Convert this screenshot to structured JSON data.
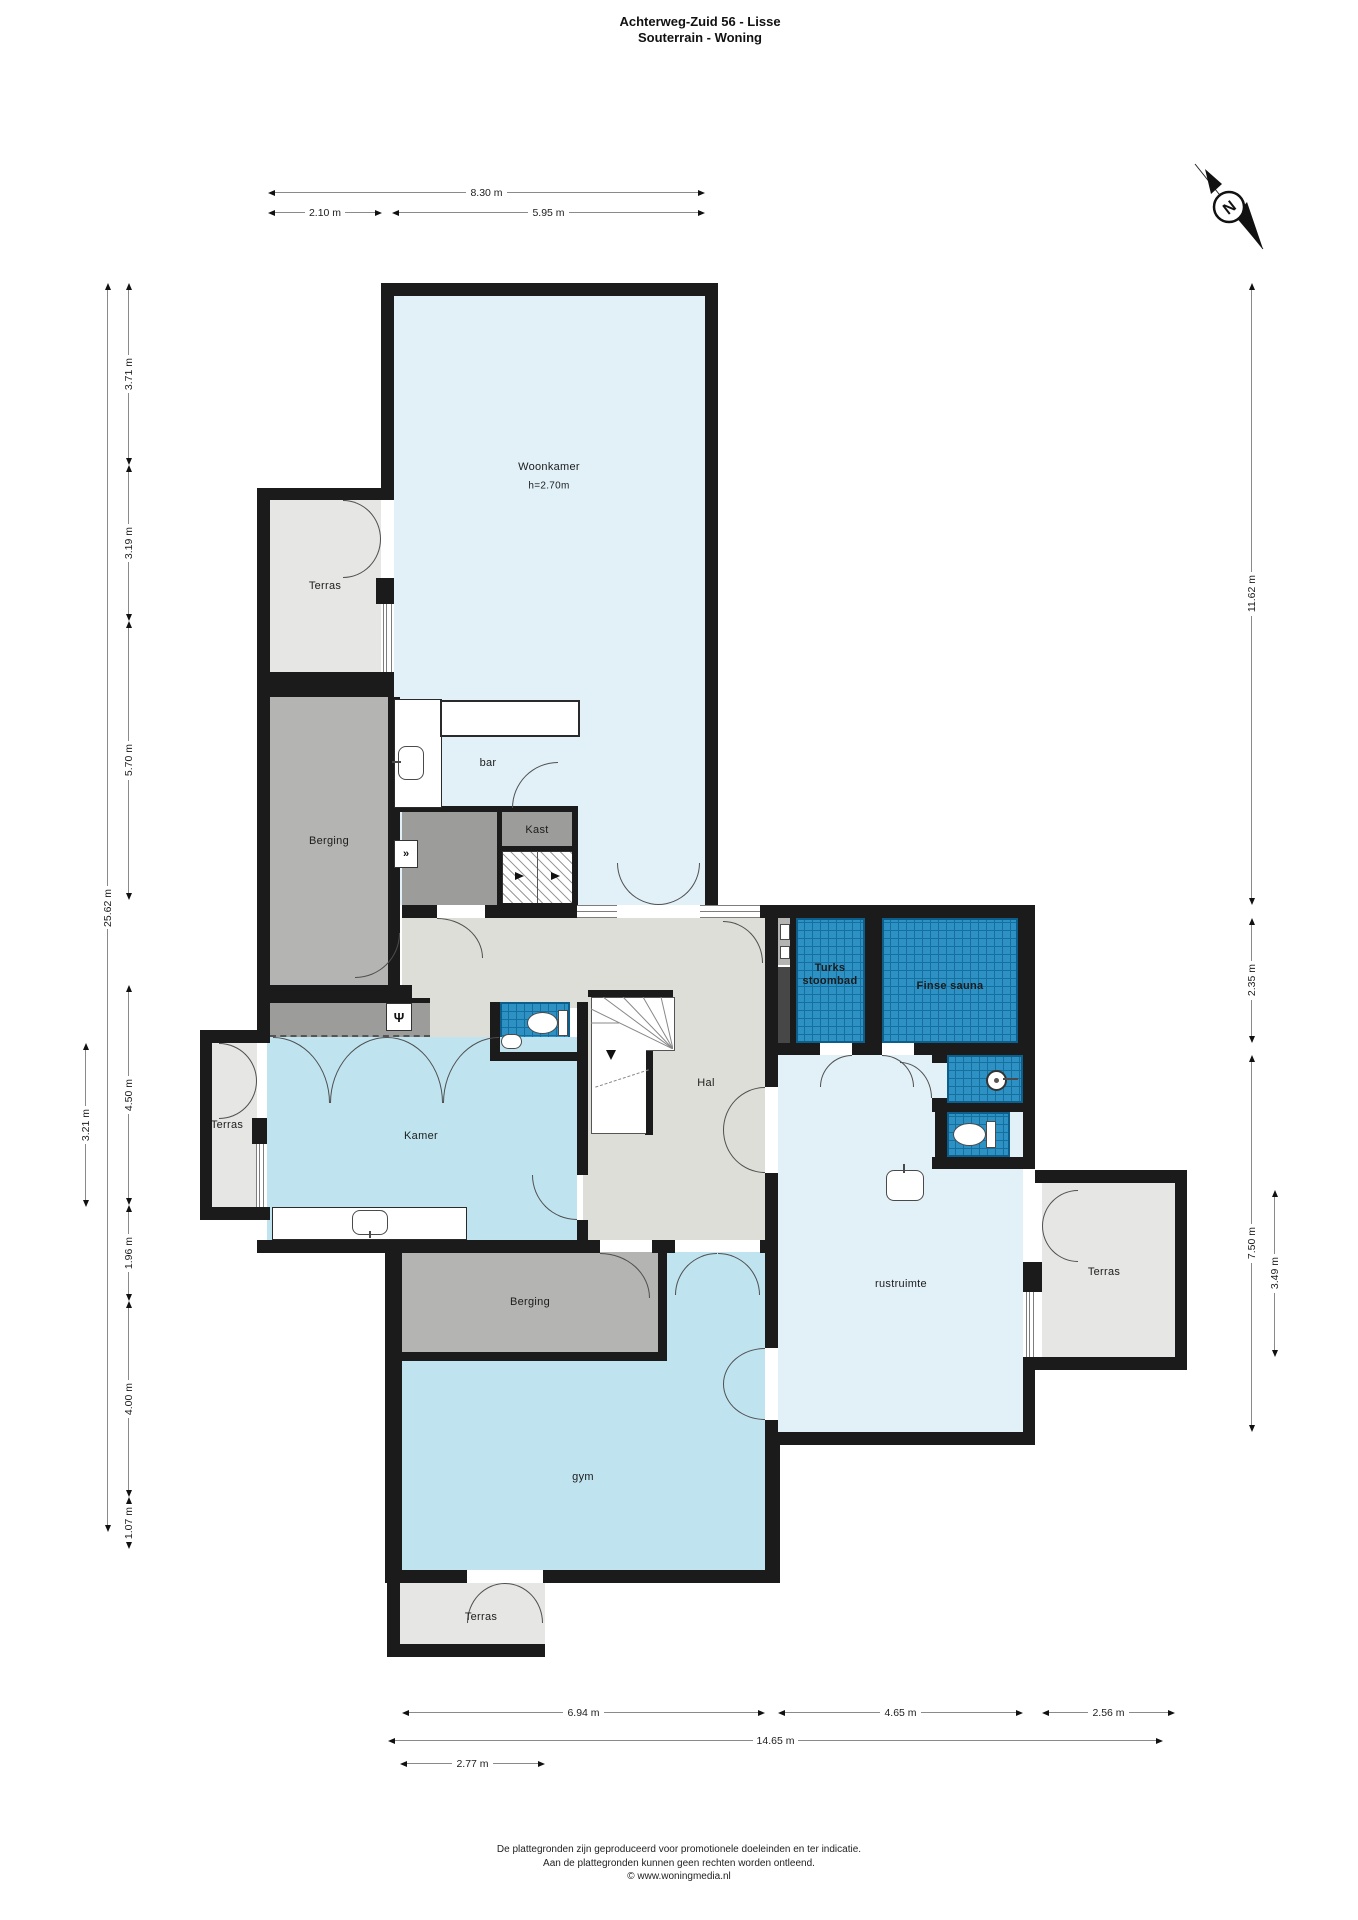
{
  "title": {
    "line1": "Achterweg-Zuid 56 - Lisse",
    "line2": "Souterrain - Woning"
  },
  "compass": {
    "label": "N"
  },
  "rooms": {
    "woonkamer": {
      "label": "Woonkamer",
      "height": "h=2.70m"
    },
    "terras_boven": {
      "label": "Terras"
    },
    "bar": {
      "label": "bar"
    },
    "berging_1": {
      "label": "Berging"
    },
    "kast": {
      "label": "Kast"
    },
    "hal": {
      "label": "Hal"
    },
    "kamer": {
      "label": "Kamer"
    },
    "terras_links": {
      "label": "Terras"
    },
    "turks_stoombad": {
      "label_line1": "Turks",
      "label_line2": "stoombad"
    },
    "finse_sauna": {
      "label": "Finse sauna"
    },
    "rustruimte": {
      "label": "rustruimte"
    },
    "terras_rechts": {
      "label": "Terras"
    },
    "berging_2": {
      "label": "Berging"
    },
    "gym": {
      "label": "gym"
    },
    "terras_onder": {
      "label": "Terras"
    }
  },
  "dims": {
    "top": [
      {
        "label": "8.30 m"
      },
      {
        "label": "2.10 m"
      },
      {
        "label": "5.95 m"
      }
    ],
    "left": [
      {
        "label": "25.62 m"
      },
      {
        "label": "3.71 m"
      },
      {
        "label": "3.19 m"
      },
      {
        "label": "5.70 m"
      },
      {
        "label": "4.50 m"
      },
      {
        "label": "1.96 m"
      },
      {
        "label": "4.00 m"
      },
      {
        "label": "1.07 m"
      },
      {
        "label": "3.21 m"
      }
    ],
    "right": [
      {
        "label": "11.62 m"
      },
      {
        "label": "2.35 m"
      },
      {
        "label": "7.50 m"
      },
      {
        "label": "3.49 m"
      }
    ],
    "bottom": [
      {
        "label": "6.94 m"
      },
      {
        "label": "4.65 m"
      },
      {
        "label": "2.56 m"
      },
      {
        "label": "14.65 m"
      },
      {
        "label": "2.77 m"
      }
    ]
  },
  "icons": {
    "wardrobe_glyph": "Ψ",
    "utility_glyph": "»"
  },
  "footer": {
    "line1": "De plattegronden zijn geproduceerd voor promotionele doeleinden en ter indicatie.",
    "line2": "Aan de plattegronden kunnen geen rechten worden ontleend.",
    "line3": "© www.woningmedia.nl"
  },
  "colors": {
    "wall": "#1b1b1b",
    "room_pale_blue": "#e2f1f8",
    "room_cyan": "#bfe4f0",
    "terrace_gray": "#e6e6e5",
    "storage_gray": "#b4b4b2",
    "closet_gray": "#9c9c9a",
    "hall_gray": "#deded9",
    "tile_blue": "#2d91c4",
    "tile_grid": "#15709f"
  }
}
